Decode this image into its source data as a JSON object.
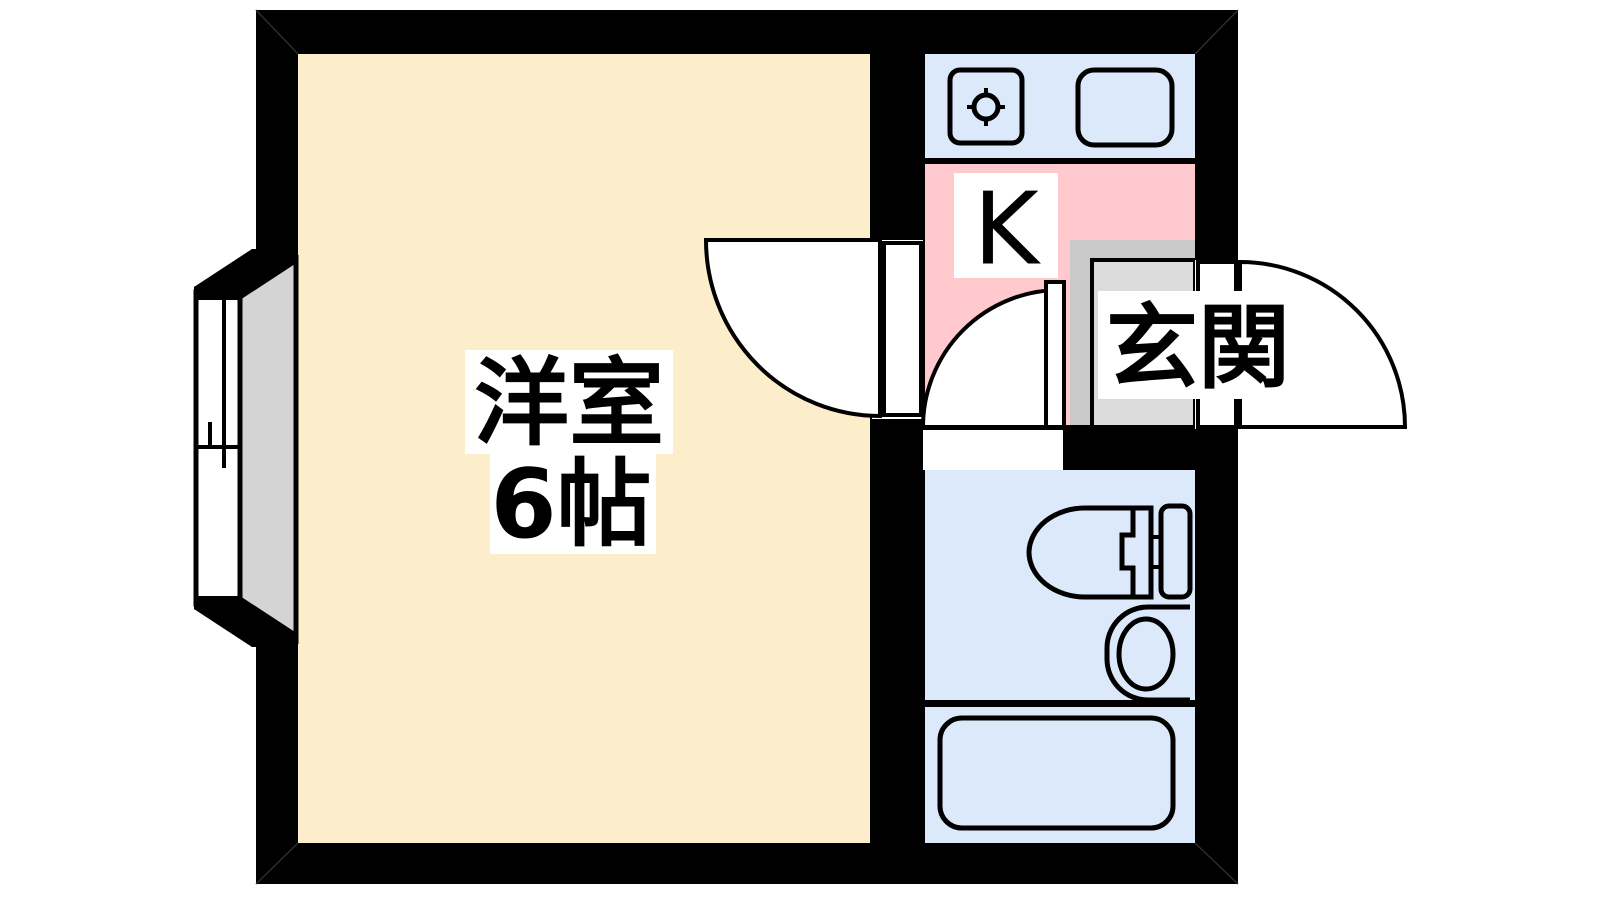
{
  "labels": {
    "main_room": "洋室",
    "main_room_size": "6帖",
    "kitchen": "K",
    "entrance": "玄関"
  },
  "fixtures": {
    "kitchen_sink": "sink-with-drain",
    "kitchen_stove": "stove-top",
    "toilet": "toilet",
    "wash_basin": "wash-basin",
    "bathtub": "bathtub",
    "window": "sliding-bay-window",
    "doors": "three-swing-doors"
  },
  "colors": {
    "wall": "#000000",
    "room_floor": "#fdeecb",
    "kitchen_floor": "#ffc9ce",
    "wet_area": "#dbe9fb",
    "entrance_step": "#c9c9c9",
    "entrance_step_inner": "#dbdbdb",
    "bay_floor": "#d4d4d4",
    "label_bg": "#ffffff",
    "background": "#ffffff"
  }
}
